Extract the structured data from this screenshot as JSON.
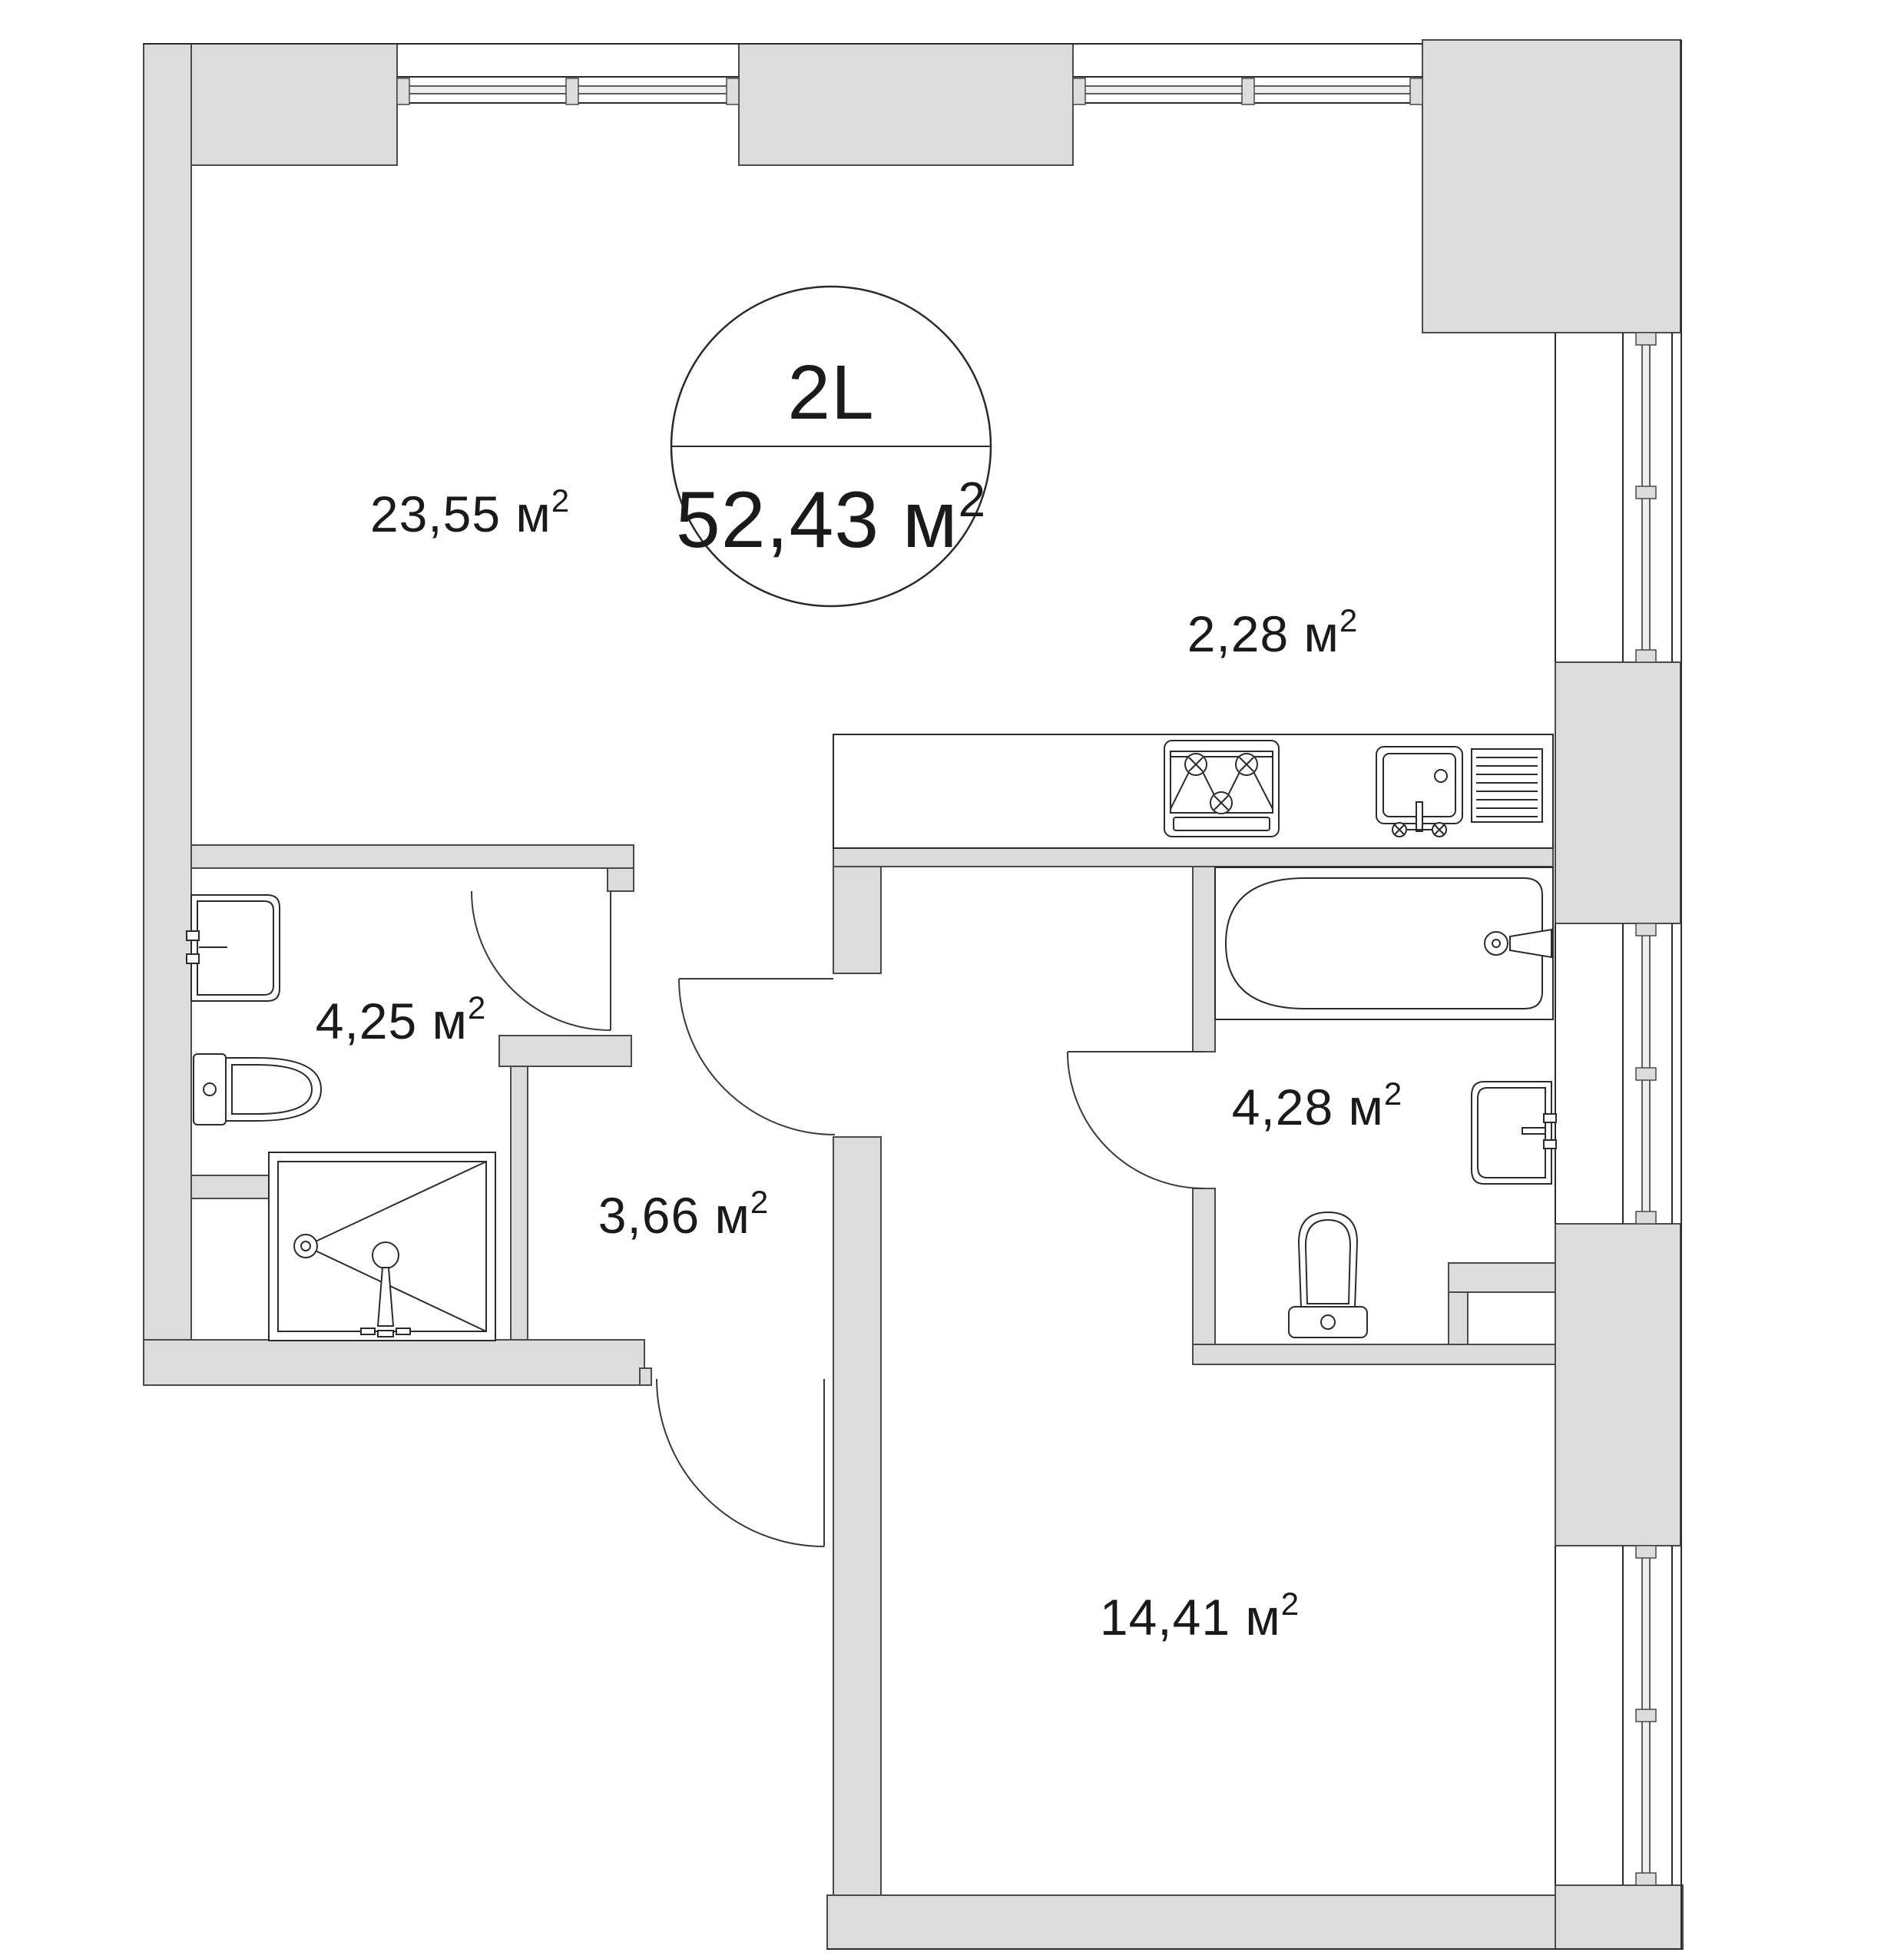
{
  "plan": {
    "badge": {
      "unit_id": "2L",
      "total_area": "52,43 м",
      "total_area_sup": "2"
    },
    "rooms": [
      {
        "name": "living-room",
        "area_label": "23,55 м",
        "sup": "2"
      },
      {
        "name": "kitchen-zone",
        "area_label": "2,28 м",
        "sup": "2"
      },
      {
        "name": "bathroom-small",
        "area_label": "4,25 м",
        "sup": "2"
      },
      {
        "name": "hallway",
        "area_label": "3,66 м",
        "sup": "2"
      },
      {
        "name": "bathroom-large",
        "area_label": "4,28 м",
        "sup": "2"
      },
      {
        "name": "bedroom",
        "area_label": "14,41 м",
        "sup": "2"
      }
    ],
    "fixtures": [
      "bathtub",
      "shower-cabin",
      "toilet-left",
      "toilet-right",
      "wall-sink-left",
      "wall-sink-right",
      "kitchen-sink-with-drainboard",
      "gas-hob",
      "kitchen-counter"
    ],
    "colors": {
      "wall_fill": "#dcdcdc",
      "wall_stroke": "#4a4a4a",
      "line_color": "#2b2b2b",
      "text_color": "#1a1a1a",
      "glass_fill": "#eeeeee"
    }
  }
}
